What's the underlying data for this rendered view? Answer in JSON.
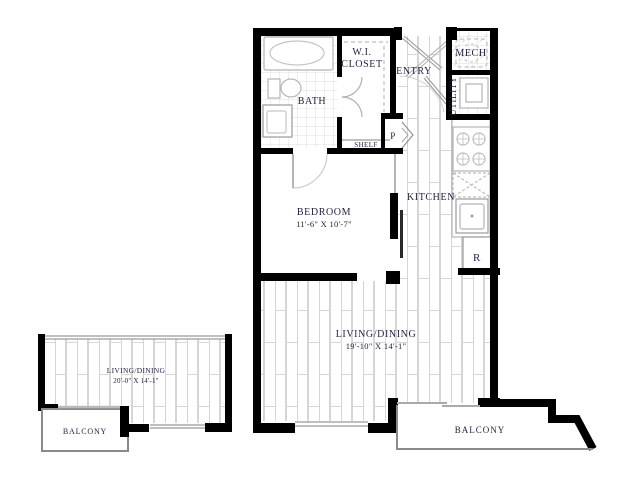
{
  "title": "Apartment unit floor plan",
  "colors": {
    "wall": "#000000",
    "floor_line": "#d6d6d6",
    "fixture_line": "#b5b5b5",
    "outline_thin": "#8a8a8a",
    "text": "#232343",
    "background": "#ffffff"
  },
  "main_plan": {
    "rooms": {
      "bath": {
        "label": "BATH"
      },
      "wi_closet": {
        "label_line1": "W.I.",
        "label_line2": "CLOSET"
      },
      "entry": {
        "label": "ENTRY"
      },
      "mech": {
        "label": "MECH"
      },
      "utility": {
        "label": "UTILITY"
      },
      "pantry": {
        "label": "P"
      },
      "shelf": {
        "label": "SHELF"
      },
      "kitchen": {
        "label": "KITCHEN"
      },
      "refrigerator": {
        "label": "R"
      },
      "bedroom": {
        "label": "BEDROOM",
        "dimensions": "11'-6\" X 10'-7\""
      },
      "living_dining": {
        "label": "LIVING/DINING",
        "dimensions": "19'-10\" X 14'-1\""
      },
      "balcony": {
        "label": "BALCONY"
      }
    }
  },
  "alt_plan": {
    "rooms": {
      "living_dining": {
        "label": "LIVING/DINING",
        "dimensions": "20'-0\" X 14'-1\""
      },
      "balcony": {
        "label": "BALCONY"
      }
    }
  }
}
